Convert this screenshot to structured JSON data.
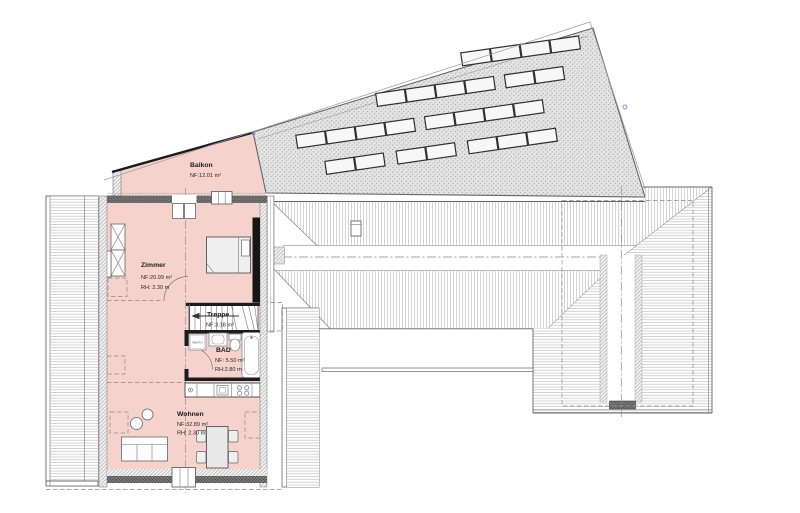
{
  "rooms": {
    "balkon": {
      "name": "Balkon",
      "area": "NF:12.01 m²"
    },
    "zimmer": {
      "name": "Zimmer",
      "area": "NF:20.99 m²",
      "height": "RH: 2.30 m"
    },
    "treppe": {
      "name": "Treppe",
      "area": "NF:3.18 m²"
    },
    "bad": {
      "name": "BAD",
      "area": "NF: 5.50 m²",
      "height": "RH:2.80 m"
    },
    "wohnen": {
      "name": "Wohnen",
      "area": "NF:32.89 m²",
      "height": "RH: 2.30 m"
    }
  },
  "fixtures": {
    "washer_label": "WM/TU"
  },
  "colors": {
    "room_fill": "#f5d3cc",
    "panel_fill": "#f7f7f7",
    "wall_dark": "#1c1c1c",
    "survey_marker_blue": "#7b68ee",
    "line_gray": "#666666"
  },
  "roof": {
    "panel_width": 29,
    "panel_height": 13,
    "rotation_deg": -8.2,
    "pivot_x": 430,
    "pivot_y": 120,
    "panel_rows": [
      {
        "y": 58,
        "x_positions": [
          470,
          500,
          530,
          560
        ]
      },
      {
        "y": 86,
        "x_positions": [
          380,
          410,
          440,
          470,
          510,
          540
        ]
      },
      {
        "y": 116,
        "x_positions": [
          295,
          325,
          355,
          385,
          425,
          455,
          485,
          515
        ]
      },
      {
        "y": 146,
        "x_positions": [
          320,
          350,
          392,
          422,
          464,
          494,
          524
        ]
      }
    ]
  }
}
